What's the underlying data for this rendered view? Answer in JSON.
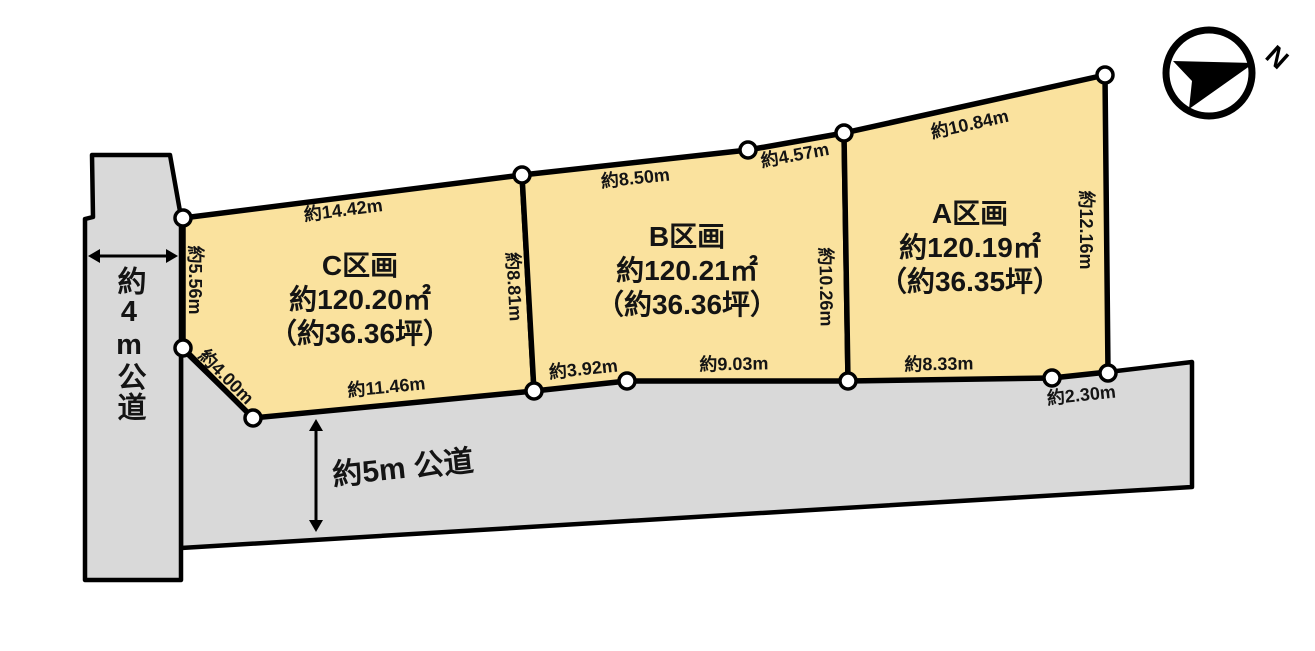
{
  "compass": {
    "north_label": "N"
  },
  "roads": {
    "left_label": "約4m公道",
    "bottom_label": "約5m 公道"
  },
  "plots": {
    "c": {
      "name": "C区画",
      "area": "約120.20㎡",
      "tsubo": "（約36.36坪）"
    },
    "b": {
      "name": "B区画",
      "area": "約120.21㎡",
      "tsubo": "（約36.36坪）"
    },
    "a": {
      "name": "A区画",
      "area": "約120.19㎡",
      "tsubo": "（約36.35坪）"
    }
  },
  "dimensions": {
    "c_top": "約14.42m",
    "c_left": "約5.56m",
    "c_corner": "約4.00m",
    "c_bottom": "約11.46m",
    "cb_boundary": "約8.81m",
    "b_top": "約8.50m",
    "b_top_right": "約4.57m",
    "b_bottom_left": "約3.92m",
    "b_bottom": "約9.03m",
    "ba_boundary": "約10.26m",
    "a_top": "約10.84m",
    "a_right": "約12.16m",
    "a_bottom": "約8.33m",
    "a_bottom_right": "約2.30m"
  },
  "colors": {
    "plot_fill": "#fae29e",
    "road_fill": "#d9d9d9",
    "line": "#000000",
    "text": "#141414"
  }
}
